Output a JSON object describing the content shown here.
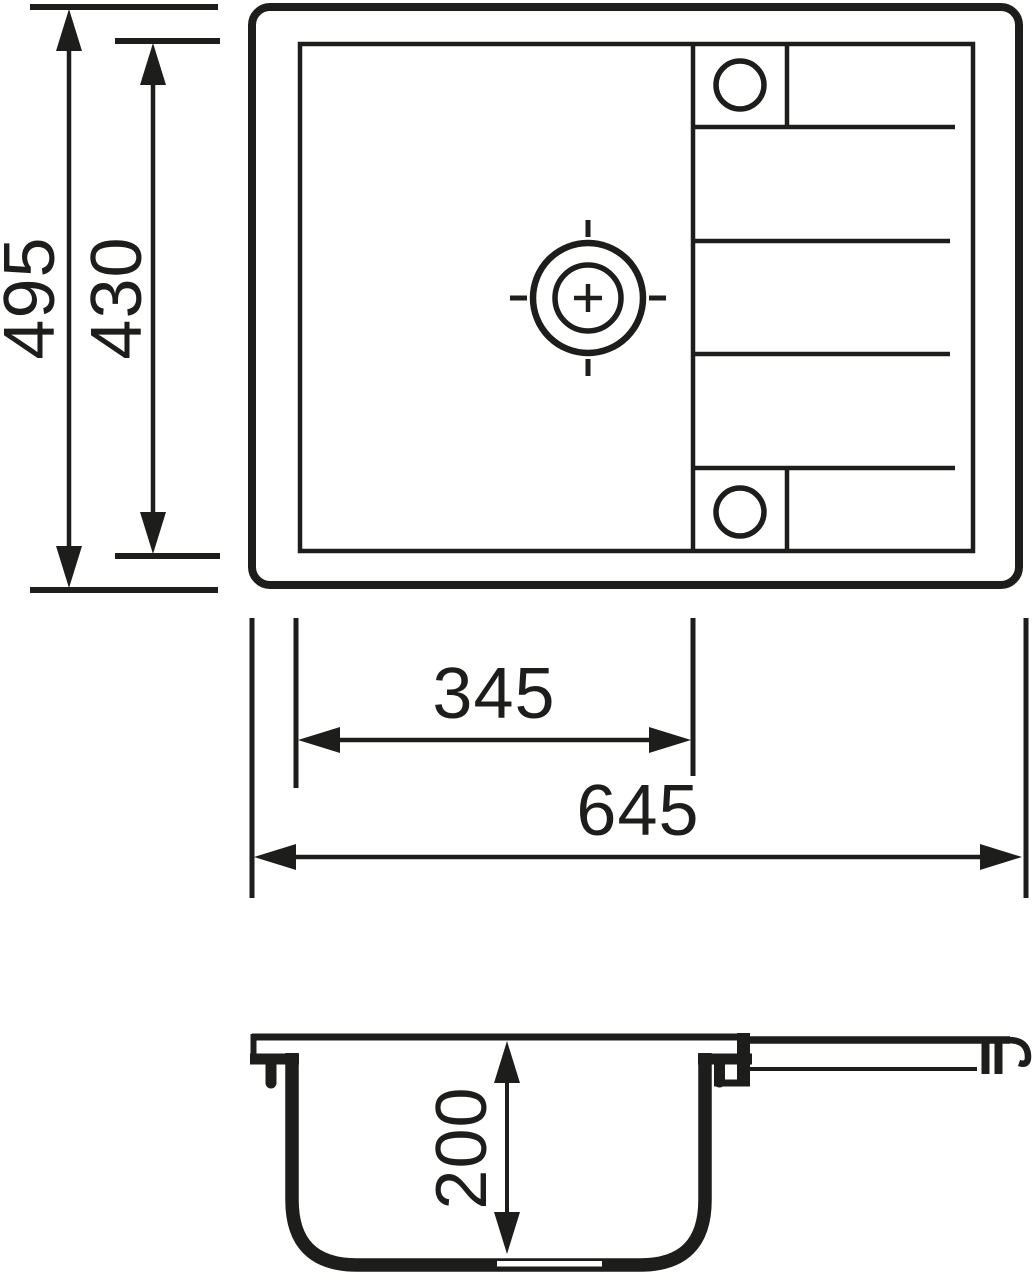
{
  "colors": {
    "line": "#1d1d1b",
    "background": "#ffffff"
  },
  "dimensions": {
    "overall_height": "495",
    "inner_height": "430",
    "bowl_width": "345",
    "overall_width": "645",
    "bowl_depth": "200"
  }
}
